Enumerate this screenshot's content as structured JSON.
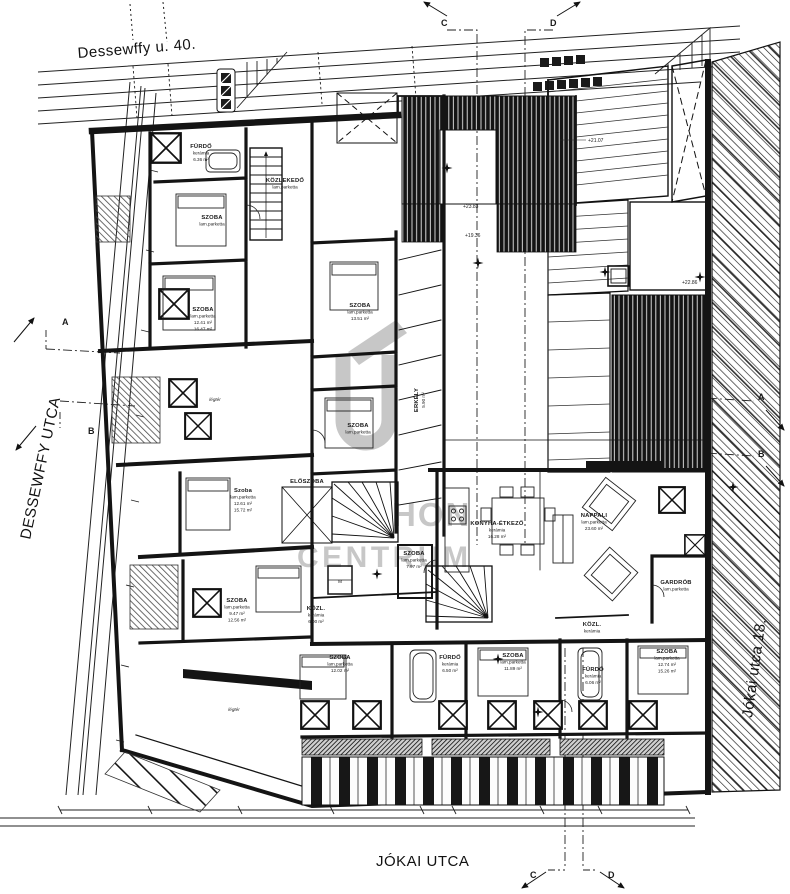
{
  "drawing": {
    "street_top_label": "Dessewffy u. 40.",
    "street_left_label": "DESSEWFFY UTCA",
    "street_bottom_label": "JÓKAI UTCA",
    "neighbor_right_label": "Jókai utca 18."
  },
  "sections": {
    "a": "A",
    "b": "B",
    "c": "C",
    "d": "D"
  },
  "watermark": {
    "text_top": "HON",
    "text_bottom": "CENTRUM"
  },
  "lift_label": "M",
  "rooms": {
    "furdo1": {
      "label": "FÜRDŐ",
      "sub": "kerámia",
      "area": "6.36 m²"
    },
    "kozlekedo": {
      "label": "KÖZLEKEDŐ",
      "sub": "lam.parketta"
    },
    "szoba1": {
      "label": "SZOBA",
      "sub": "lam.parketta"
    },
    "szoba2": {
      "label": "SZOBA",
      "sub": "lam.parketta",
      "area": "12.41 m²",
      "area2": "16.47 m²"
    },
    "szoba3": {
      "label": "SZOBA",
      "sub": "lam.parketta",
      "area": "13.51 m²"
    },
    "erkely": {
      "label": "ERKÉLY",
      "area": "5.90 m²"
    },
    "szoba4": {
      "label": "SZOBA",
      "sub": "lam.parketta"
    },
    "legter1": {
      "label": "légtér"
    },
    "szoba5": {
      "label": "Szoba",
      "sub": "lam.parketta",
      "area": "12.61 m²",
      "area2": "15.72 m²"
    },
    "eloszoba": {
      "label": "ELŐSZOBA"
    },
    "kozl1": {
      "label": "KÖZL.",
      "sub": "kerámia",
      "area": "6.00 m²"
    },
    "szoba6": {
      "label": "SZOBA",
      "sub": "lam.parketta",
      "area": "7.97 m²"
    },
    "konyha": {
      "label": "KONYHA-ÉTKEZŐ",
      "sub": "kerámia",
      "area": "16.28 m²"
    },
    "nappali": {
      "label": "NAPPALI",
      "sub": "lam.parketta",
      "area": "23.60 m²"
    },
    "gardrob": {
      "label": "GARDRÓB",
      "sub": "lam.parketta"
    },
    "kozl2": {
      "label": "KÖZL.",
      "sub": "kerámia"
    },
    "szoba7": {
      "label": "SZOBA",
      "sub": "lam.parketta",
      "area": "12.02 m²"
    },
    "furdo2": {
      "label": "FÜRDŐ",
      "sub": "kerámia",
      "area": "6.50 m²"
    },
    "szoba8": {
      "label": "SZOBA",
      "sub": "lam.parketta",
      "area": "11.89 m²"
    },
    "furdo3": {
      "label": "FÜRDŐ",
      "sub": "kerámia",
      "area": "6.06 m²"
    },
    "szoba9": {
      "label": "SZOBA",
      "sub": "lam.parketta",
      "area": "12.74 m²",
      "area2": "15.26 m²"
    },
    "szoba10": {
      "label": "SZOBA",
      "sub": "lam.parketta",
      "area": "9.47 m²",
      "area2": "12.56 m²"
    },
    "legter2": {
      "label": "légtér"
    }
  },
  "elevations": {
    "e1": "+21.07",
    "e2": "+23.83",
    "e3": "+19.36",
    "e4": "+22.86"
  }
}
